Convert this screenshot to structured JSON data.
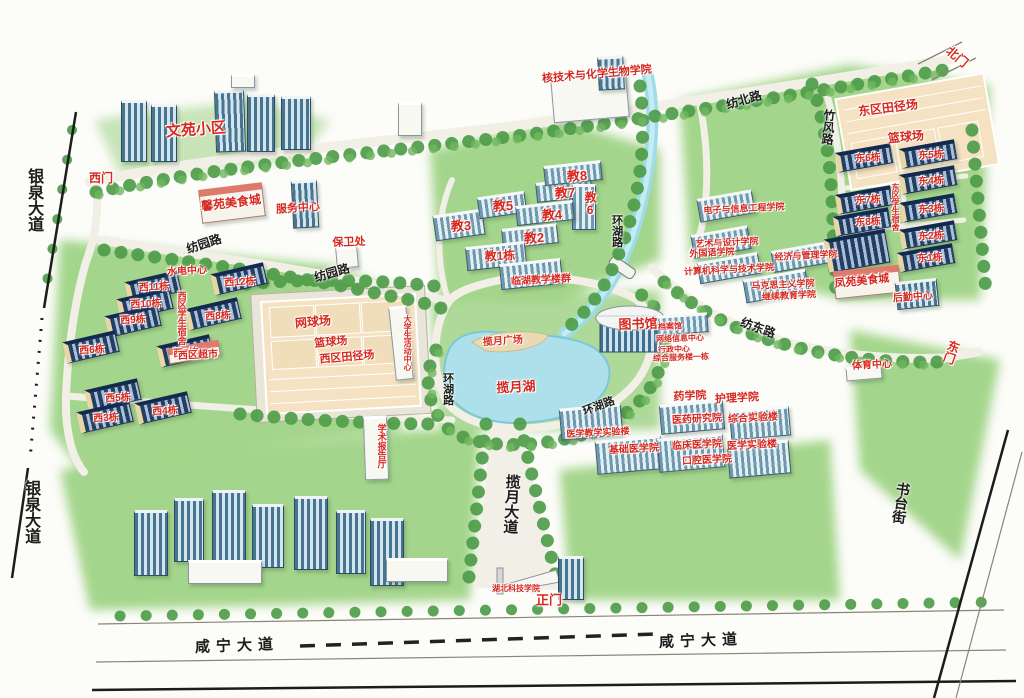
{
  "map": {
    "palette": {
      "label_red": "#d6281f",
      "road_text": "#1d1d1d",
      "lawn_green": "#9ad07f",
      "water_blue": "#aee0ec",
      "court_tan": "#f4e2c2"
    },
    "labels": [
      {
        "n": "wenyuan-compound",
        "t": "文苑小区",
        "x": 196,
        "y": 130,
        "c": "red",
        "s": 15,
        "r": -4
      },
      {
        "n": "west-gate",
        "t": "西门",
        "x": 101,
        "y": 178,
        "c": "red",
        "s": 12,
        "r": 0
      },
      {
        "n": "xinyuan-food-court",
        "t": "馨苑美食城",
        "x": 231,
        "y": 203,
        "c": "red",
        "s": 12,
        "r": -7
      },
      {
        "n": "service-center-west",
        "t": "服务中心",
        "x": 298,
        "y": 209,
        "c": "red",
        "s": 11,
        "r": -4
      },
      {
        "n": "security-office",
        "t": "保卫处",
        "x": 349,
        "y": 243,
        "c": "red",
        "s": 11,
        "r": -2
      },
      {
        "n": "nuclear-chem-bio-college",
        "t": "核技术与化学生物学院",
        "x": 597,
        "y": 75,
        "c": "red",
        "s": 11,
        "r": -5
      },
      {
        "n": "water-power-center",
        "t": "水电中心",
        "x": 187,
        "y": 272,
        "c": "red",
        "s": 10,
        "r": -3
      },
      {
        "n": "west-dorm-12",
        "t": "西12栋",
        "x": 240,
        "y": 283,
        "c": "red",
        "s": 10,
        "r": -3
      },
      {
        "n": "west-dorm-11",
        "t": "西11栋",
        "x": 154,
        "y": 288,
        "c": "red",
        "s": 10,
        "r": -3
      },
      {
        "n": "west-dorm-10",
        "t": "西10栋",
        "x": 146,
        "y": 305,
        "c": "red",
        "s": 10,
        "r": -3
      },
      {
        "n": "west-dorm-9",
        "t": "西9栋",
        "x": 133,
        "y": 321,
        "c": "red",
        "s": 10,
        "r": -3
      },
      {
        "n": "west-dorm-8",
        "t": "西8栋",
        "x": 218,
        "y": 317,
        "c": "red",
        "s": 10,
        "r": -3
      },
      {
        "n": "west-dorm-7",
        "t": "西7栋",
        "x": 186,
        "y": 354,
        "c": "red",
        "s": 10,
        "r": -3
      },
      {
        "n": "west-dorm-6",
        "t": "西6栋",
        "x": 92,
        "y": 351,
        "c": "red",
        "s": 10,
        "r": -3
      },
      {
        "n": "west-supermarket",
        "t": "西区超市",
        "x": 198,
        "y": 356,
        "c": "red",
        "s": 10,
        "r": -3
      },
      {
        "n": "west-dorm-5",
        "t": "西5栋",
        "x": 118,
        "y": 399,
        "c": "red",
        "s": 10,
        "r": -3
      },
      {
        "n": "west-dorm-4",
        "t": "西4栋",
        "x": 165,
        "y": 412,
        "c": "red",
        "s": 10,
        "r": -3
      },
      {
        "n": "west-dorm-3",
        "t": "西3栋",
        "x": 106,
        "y": 419,
        "c": "red",
        "s": 10,
        "r": -3
      },
      {
        "n": "west-dorm-area",
        "t": "西区学生宿舍",
        "x": 181,
        "y": 318,
        "c": "red",
        "s": 9,
        "r": 0,
        "v": true
      },
      {
        "n": "tennis-courts",
        "t": "网球场",
        "x": 313,
        "y": 322,
        "c": "red",
        "s": 12,
        "r": -5
      },
      {
        "n": "basketball-court-west",
        "t": "篮球场",
        "x": 331,
        "y": 343,
        "c": "red",
        "s": 11,
        "r": -5
      },
      {
        "n": "west-athletic-field",
        "t": "西区田径场",
        "x": 347,
        "y": 358,
        "c": "red",
        "s": 11,
        "r": -5
      },
      {
        "n": "student-activity-center",
        "t": "大学生活动中心",
        "x": 407,
        "y": 343,
        "c": "red",
        "s": 8,
        "r": 0,
        "v": true
      },
      {
        "n": "lecture-hall",
        "t": "学术报告厅",
        "x": 381,
        "y": 446,
        "c": "red",
        "s": 9,
        "r": 0,
        "v": true
      },
      {
        "n": "teach-3",
        "t": "教3",
        "x": 461,
        "y": 226,
        "c": "red",
        "s": 13,
        "r": -3
      },
      {
        "n": "teach-5",
        "t": "教5",
        "x": 503,
        "y": 206,
        "c": "red",
        "s": 13,
        "r": -3
      },
      {
        "n": "teach-7",
        "t": "教7",
        "x": 565,
        "y": 193,
        "c": "red",
        "s": 13,
        "r": -3
      },
      {
        "n": "teach-8",
        "t": "教8",
        "x": 577,
        "y": 176,
        "c": "red",
        "s": 13,
        "r": -3
      },
      {
        "n": "teach-6",
        "t": "教6",
        "x": 590,
        "y": 204,
        "c": "red",
        "s": 12,
        "r": 0,
        "v": true
      },
      {
        "n": "teach-4",
        "t": "教4",
        "x": 552,
        "y": 215,
        "c": "red",
        "s": 13,
        "r": -3
      },
      {
        "n": "teach-2",
        "t": "教2",
        "x": 534,
        "y": 238,
        "c": "red",
        "s": 13,
        "r": -3
      },
      {
        "n": "teach-1",
        "t": "教1栋",
        "x": 500,
        "y": 256,
        "c": "red",
        "s": 12,
        "r": -3
      },
      {
        "n": "lakeside-teaching",
        "t": "临湖教学楼群",
        "x": 541,
        "y": 281,
        "c": "red",
        "s": 10,
        "r": -3
      },
      {
        "n": "lanyue-plaza",
        "t": "揽月广场",
        "x": 503,
        "y": 342,
        "c": "red",
        "s": 10,
        "r": -4
      },
      {
        "n": "lanyue-lake",
        "t": "揽月湖",
        "x": 516,
        "y": 387,
        "c": "red",
        "s": 13,
        "r": -3
      },
      {
        "n": "library",
        "t": "图书馆",
        "x": 638,
        "y": 324,
        "c": "red",
        "s": 13,
        "r": -2
      },
      {
        "n": "archives",
        "t": "档案馆",
        "x": 670,
        "y": 327,
        "c": "red",
        "s": 8,
        "r": -2
      },
      {
        "n": "network-info-center",
        "t": "网络信息中心",
        "x": 680,
        "y": 339,
        "c": "red",
        "s": 8,
        "r": -2
      },
      {
        "n": "admin-center",
        "t": "行政中心",
        "x": 674,
        "y": 350,
        "c": "red",
        "s": 8,
        "r": -2
      },
      {
        "n": "service-building-1",
        "t": "综合服务楼一栋",
        "x": 681,
        "y": 358,
        "c": "red",
        "s": 8,
        "r": -2
      },
      {
        "n": "pharmacy-college",
        "t": "药学院",
        "x": 690,
        "y": 397,
        "c": "red",
        "s": 11,
        "r": -3
      },
      {
        "n": "nursing-college",
        "t": "护理学院",
        "x": 737,
        "y": 399,
        "c": "red",
        "s": 11,
        "r": -3
      },
      {
        "n": "medical-research-institute",
        "t": "医药研究院",
        "x": 697,
        "y": 420,
        "c": "red",
        "s": 10,
        "r": -3
      },
      {
        "n": "comprehensive-lab",
        "t": "综合实验楼",
        "x": 753,
        "y": 419,
        "c": "red",
        "s": 10,
        "r": -3
      },
      {
        "n": "clinical-medicine-college",
        "t": "临床医学院",
        "x": 697,
        "y": 446,
        "c": "red",
        "s": 10,
        "r": -3
      },
      {
        "n": "medical-lab",
        "t": "医学实验楼",
        "x": 752,
        "y": 446,
        "c": "red",
        "s": 10,
        "r": -3
      },
      {
        "n": "stomatology-college",
        "t": "口腔医学院",
        "x": 707,
        "y": 461,
        "c": "red",
        "s": 10,
        "r": -3
      },
      {
        "n": "basic-medicine-college",
        "t": "基础医学院",
        "x": 634,
        "y": 450,
        "c": "red",
        "s": 10,
        "r": -3
      },
      {
        "n": "medical-teaching-lab",
        "t": "医学教学实验楼",
        "x": 598,
        "y": 433,
        "c": "red",
        "s": 9,
        "r": -3
      },
      {
        "n": "fengyuan-food-court",
        "t": "凤苑美食城",
        "x": 862,
        "y": 282,
        "c": "red",
        "s": 11,
        "r": -6
      },
      {
        "n": "logistics-center",
        "t": "后勤中心",
        "x": 913,
        "y": 298,
        "c": "red",
        "s": 10,
        "r": -4
      },
      {
        "n": "east-athletic-field",
        "t": "东区田径场",
        "x": 888,
        "y": 108,
        "c": "red",
        "s": 12,
        "r": -7
      },
      {
        "n": "basketball-court-east",
        "t": "篮球场",
        "x": 906,
        "y": 137,
        "c": "red",
        "s": 12,
        "r": -5
      },
      {
        "n": "east-dorm-6",
        "t": "东6栋",
        "x": 868,
        "y": 159,
        "c": "red",
        "s": 10,
        "r": -3
      },
      {
        "n": "east-dorm-5",
        "t": "东5栋",
        "x": 931,
        "y": 156,
        "c": "red",
        "s": 10,
        "r": -3
      },
      {
        "n": "east-dorm-4",
        "t": "东4栋",
        "x": 931,
        "y": 182,
        "c": "red",
        "s": 10,
        "r": -3
      },
      {
        "n": "east-dorm-7",
        "t": "东7栋",
        "x": 868,
        "y": 201,
        "c": "red",
        "s": 10,
        "r": -3
      },
      {
        "n": "east-dorm-3",
        "t": "东3栋",
        "x": 931,
        "y": 210,
        "c": "red",
        "s": 10,
        "r": -3
      },
      {
        "n": "east-dorm-8",
        "t": "东8栋",
        "x": 868,
        "y": 223,
        "c": "red",
        "s": 10,
        "r": -3
      },
      {
        "n": "east-dorm-2",
        "t": "东2栋",
        "x": 931,
        "y": 237,
        "c": "red",
        "s": 10,
        "r": -3
      },
      {
        "n": "east-dorm-1",
        "t": "东1栋",
        "x": 930,
        "y": 259,
        "c": "red",
        "s": 10,
        "r": -3
      },
      {
        "n": "east-dorm-area",
        "t": "东区学生宿舍",
        "x": 895,
        "y": 207,
        "c": "red",
        "s": 8,
        "r": 0,
        "v": true
      },
      {
        "n": "sports-center",
        "t": "体育中心",
        "x": 872,
        "y": 366,
        "c": "red",
        "s": 10,
        "r": -3
      },
      {
        "n": "east-gate",
        "t": "东门",
        "x": 951,
        "y": 352,
        "c": "red",
        "s": 12,
        "r": 20,
        "v": true
      },
      {
        "n": "north-gate",
        "t": "北门",
        "x": 957,
        "y": 57,
        "c": "red",
        "s": 12,
        "r": 40
      },
      {
        "n": "main-gate",
        "t": "正门",
        "x": 549,
        "y": 600,
        "c": "red",
        "s": 13,
        "r": 0
      },
      {
        "n": "university-name",
        "t": "湖北科技学院",
        "x": 516,
        "y": 589,
        "c": "red",
        "s": 8,
        "r": 0
      },
      {
        "n": "electronics-info-college",
        "t": "电子与信息工程学院",
        "x": 744,
        "y": 209,
        "c": "red",
        "s": 9,
        "r": -3
      },
      {
        "n": "art-design-college",
        "t": "艺术与设计学院",
        "x": 727,
        "y": 243,
        "c": "red",
        "s": 9,
        "r": -3
      },
      {
        "n": "foreign-language-college",
        "t": "外国语学院",
        "x": 712,
        "y": 253,
        "c": "red",
        "s": 9,
        "r": -3
      },
      {
        "n": "economics-management-college",
        "t": "经济与管理学院",
        "x": 806,
        "y": 256,
        "c": "red",
        "s": 9,
        "r": -3
      },
      {
        "n": "computer-science-college",
        "t": "计算机科学与技术学院",
        "x": 729,
        "y": 270,
        "c": "red",
        "s": 9,
        "r": -3
      },
      {
        "n": "marxism-college",
        "t": "马克思主义学院",
        "x": 783,
        "y": 285,
        "c": "red",
        "s": 9,
        "r": -3
      },
      {
        "n": "continuing-education-college",
        "t": "继续教育学院",
        "x": 789,
        "y": 296,
        "c": "red",
        "s": 9,
        "r": -3
      },
      {
        "n": "yinquan-avenue-north",
        "t": "银泉大道",
        "x": 33,
        "y": 200,
        "c": "black",
        "s": 16,
        "r": 0,
        "v": true
      },
      {
        "n": "yinquan-avenue-south",
        "t": "银泉大道",
        "x": 30,
        "y": 512,
        "c": "black",
        "s": 16,
        "r": 0,
        "v": true
      },
      {
        "n": "xianning-avenue-west",
        "t": "咸宁大道",
        "x": 237,
        "y": 646,
        "c": "black",
        "s": 15,
        "r": -2,
        "ls": 6
      },
      {
        "n": "xianning-avenue-east",
        "t": "咸宁大道",
        "x": 701,
        "y": 641,
        "c": "black",
        "s": 15,
        "r": -2,
        "ls": 6
      },
      {
        "n": "fangyuan-road-west",
        "t": "纺园路",
        "x": 204,
        "y": 244,
        "c": "black",
        "s": 12,
        "r": -18
      },
      {
        "n": "fangyuan-road-east",
        "t": "纺园路",
        "x": 332,
        "y": 273,
        "c": "black",
        "s": 12,
        "r": -16
      },
      {
        "n": "fangbei-road",
        "t": "纺北路",
        "x": 744,
        "y": 100,
        "c": "black",
        "s": 12,
        "r": -16
      },
      {
        "n": "zhufeng-road",
        "t": "竹风路",
        "x": 828,
        "y": 127,
        "c": "black",
        "s": 12,
        "r": 5,
        "v": true
      },
      {
        "n": "huanhu-road-north",
        "t": "环湖路",
        "x": 616,
        "y": 231,
        "c": "black",
        "s": 11,
        "r": 0,
        "v": true
      },
      {
        "n": "huanhu-road-west",
        "t": "环湖路",
        "x": 447,
        "y": 389,
        "c": "black",
        "s": 11,
        "r": 0,
        "v": true
      },
      {
        "n": "huanhu-road-south",
        "t": "环湖路",
        "x": 599,
        "y": 407,
        "c": "black",
        "s": 11,
        "r": -20
      },
      {
        "n": "fangdong-road",
        "t": "纺东路",
        "x": 758,
        "y": 328,
        "c": "black",
        "s": 12,
        "r": 20
      },
      {
        "n": "lanyue-avenue",
        "t": "揽月大道",
        "x": 511,
        "y": 504,
        "c": "black",
        "s": 15,
        "r": 3,
        "v": true
      },
      {
        "n": "shutai-street",
        "t": "书台街",
        "x": 901,
        "y": 503,
        "c": "black",
        "s": 14,
        "r": 8,
        "v": true
      }
    ]
  }
}
